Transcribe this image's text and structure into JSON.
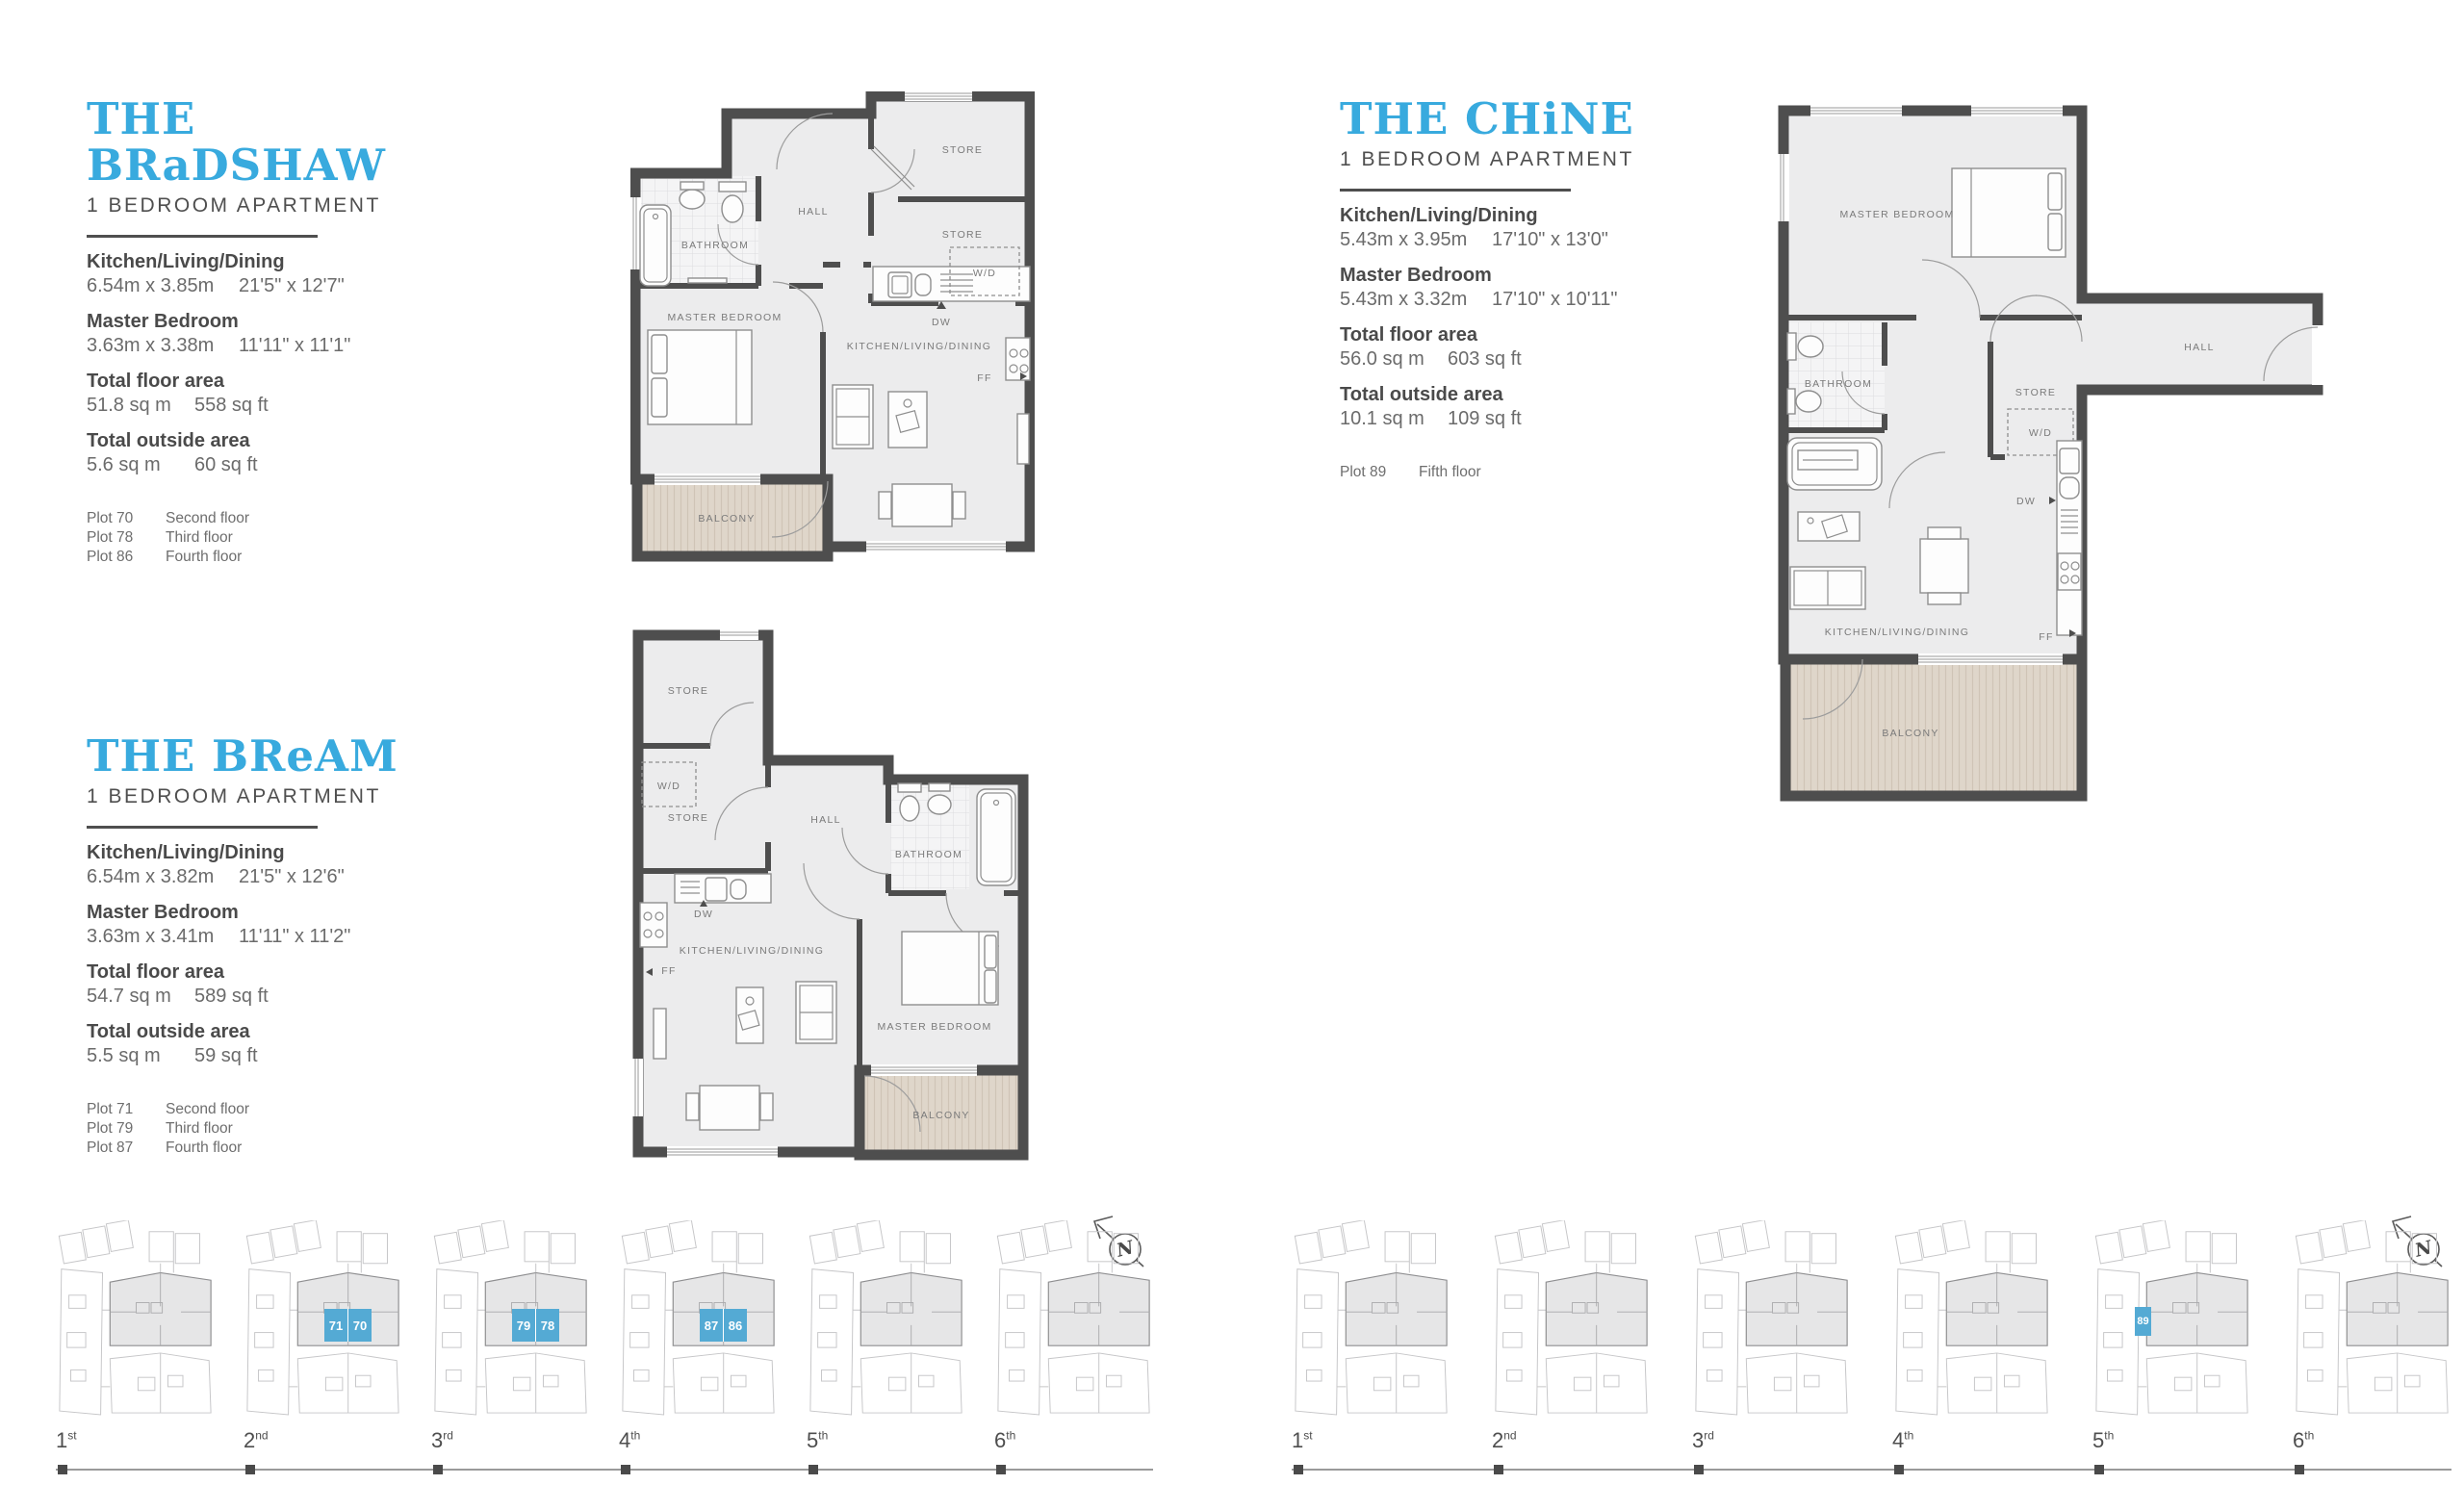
{
  "apartments": [
    {
      "id": "bradshaw",
      "title": "THE BRaDSHAW",
      "subtitle": "1 BEDROOM APARTMENT",
      "specs": [
        {
          "label": "Kitchen/Living/Dining",
          "metric": "6.54m x 3.85m",
          "imperial": "21'5\" x 12'7\""
        },
        {
          "label": "Master Bedroom",
          "metric": "3.63m x 3.38m",
          "imperial": "11'11\" x 11'1\""
        }
      ],
      "areas": [
        {
          "label": "Total floor area",
          "metric": "51.8 sq m",
          "imperial": "558 sq ft"
        },
        {
          "label": "Total outside area",
          "metric": "5.6 sq m",
          "imperial": "60 sq ft"
        }
      ],
      "plots": [
        {
          "plot": "Plot 70",
          "floor": "Second floor"
        },
        {
          "plot": "Plot 78",
          "floor": "Third floor"
        },
        {
          "plot": "Plot 86",
          "floor": "Fourth floor"
        }
      ]
    },
    {
      "id": "chine",
      "title": "THE CHiNE",
      "subtitle": "1 BEDROOM APARTMENT",
      "specs": [
        {
          "label": "Kitchen/Living/Dining",
          "metric": "5.43m x 3.95m",
          "imperial": "17'10\" x 13'0\""
        },
        {
          "label": "Master Bedroom",
          "metric": "5.43m x 3.32m",
          "imperial": "17'10\" x 10'11\""
        }
      ],
      "areas": [
        {
          "label": "Total floor area",
          "metric": "56.0 sq m",
          "imperial": "603 sq ft"
        },
        {
          "label": "Total outside area",
          "metric": "10.1 sq m",
          "imperial": "109 sq ft"
        }
      ],
      "plots": [
        {
          "plot": "Plot 89",
          "floor": "Fifth floor"
        }
      ]
    },
    {
      "id": "bream",
      "title": "THE BReAM",
      "subtitle": "1 BEDROOM APARTMENT",
      "specs": [
        {
          "label": "Kitchen/Living/Dining",
          "metric": "6.54m x 3.82m",
          "imperial": "21'5\" x 12'6\""
        },
        {
          "label": "Master Bedroom",
          "metric": "3.63m x 3.41m",
          "imperial": "11'11\" x 11'2\""
        }
      ],
      "areas": [
        {
          "label": "Total floor area",
          "metric": "54.7 sq m",
          "imperial": "589 sq ft"
        },
        {
          "label": "Total outside area",
          "metric": "5.5 sq m",
          "imperial": "59 sq ft"
        }
      ],
      "plots": [
        {
          "plot": "Plot 71",
          "floor": "Second floor"
        },
        {
          "plot": "Plot 79",
          "floor": "Third floor"
        },
        {
          "plot": "Plot 87",
          "floor": "Fourth floor"
        }
      ]
    }
  ],
  "floorplans": {
    "bradshaw": {
      "hall": "HALL",
      "bathroom": "BATHROOM",
      "master_bedroom": "MASTER BEDROOM",
      "kitchen": "KITCHEN/LIVING/DINING",
      "store1": "STORE",
      "store2": "STORE",
      "wd": "W/D",
      "balcony": "BALCONY",
      "dw": "DW",
      "ff": "FF"
    },
    "chine": {
      "master_bedroom": "MASTER BEDROOM",
      "bathroom": "BATHROOM",
      "store": "STORE",
      "wd": "W/D",
      "hall": "HALL",
      "kitchen": "KITCHEN/LIVING/DINING",
      "dw": "DW",
      "ff": "FF",
      "balcony": "BALCONY"
    },
    "bream": {
      "store1": "STORE",
      "wd": "W/D",
      "store2": "STORE",
      "hall": "HALL",
      "bathroom": "BATHROOM",
      "dw": "DW",
      "ff": "FF",
      "kitchen": "KITCHEN/LIVING/DINING",
      "master_bedroom": "MASTER BEDROOM",
      "balcony": "BALCONY"
    }
  },
  "locators": {
    "left": {
      "compass": "N",
      "floors": [
        {
          "ordinal": "1",
          "suffix": "st",
          "plots": []
        },
        {
          "ordinal": "2",
          "suffix": "nd",
          "plots": [
            "71",
            "70"
          ]
        },
        {
          "ordinal": "3",
          "suffix": "rd",
          "plots": [
            "79",
            "78"
          ]
        },
        {
          "ordinal": "4",
          "suffix": "th",
          "plots": [
            "87",
            "86"
          ]
        },
        {
          "ordinal": "5",
          "suffix": "th",
          "plots": []
        },
        {
          "ordinal": "6",
          "suffix": "th",
          "plots": []
        }
      ]
    },
    "right": {
      "compass": "N",
      "floors": [
        {
          "ordinal": "1",
          "suffix": "st",
          "plots": []
        },
        {
          "ordinal": "2",
          "suffix": "nd",
          "plots": []
        },
        {
          "ordinal": "3",
          "suffix": "rd",
          "plots": []
        },
        {
          "ordinal": "4",
          "suffix": "th",
          "plots": []
        },
        {
          "ordinal": "5",
          "suffix": "th",
          "plots": [
            "89"
          ]
        },
        {
          "ordinal": "6",
          "suffix": "th",
          "plots": []
        }
      ]
    }
  },
  "colors": {
    "accent": "#38AADE",
    "plot_highlight": "#54AAD4",
    "wall": "#4E4E4E",
    "floor_fill": "#ECECED",
    "balcony_fill": "#DFD6CA"
  }
}
